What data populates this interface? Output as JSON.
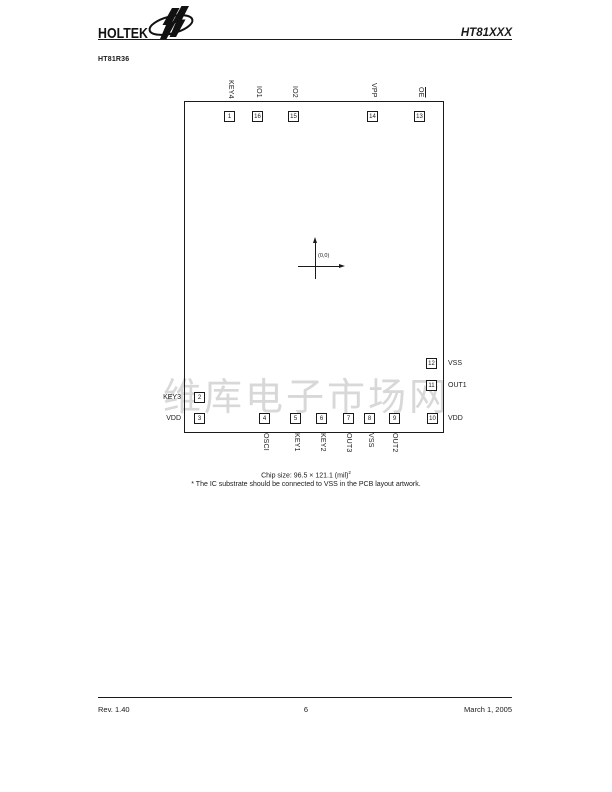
{
  "header": {
    "brand": "HOLTEK",
    "doc_title": "HT81XXX"
  },
  "section_title": "HT81R36",
  "diagram": {
    "origin_label": "(0,0)",
    "top_pads": [
      {
        "num": "1",
        "label": "KEY4"
      },
      {
        "num": "16",
        "label": "IO1"
      },
      {
        "num": "15",
        "label": "IO2"
      },
      {
        "num": "14",
        "label": "VPP"
      },
      {
        "num": "13",
        "label": "OE",
        "overline": true
      }
    ],
    "left_pads": [
      {
        "num": "2",
        "label": "KEY3"
      },
      {
        "num": "3",
        "label": "VDD"
      }
    ],
    "right_pads": [
      {
        "num": "12",
        "label": "VSS"
      },
      {
        "num": "11",
        "label": "OUT1"
      },
      {
        "num": "10",
        "label": "VDD"
      }
    ],
    "bottom_pads": [
      {
        "num": "4",
        "label": "OSCI"
      },
      {
        "num": "5",
        "label": "KEY1"
      },
      {
        "num": "6",
        "label": "KEY2"
      },
      {
        "num": "7",
        "label": "OUT3"
      },
      {
        "num": "8",
        "label": "VSS"
      },
      {
        "num": "9",
        "label": "OUT2"
      }
    ],
    "caption_line1": "Chip size: 96.5 × 121.1 (mil)",
    "caption_sup": "2",
    "caption_line2": "* The IC substrate should be connected to VSS in the PCB layout artwork."
  },
  "watermark": "维库电子市场网",
  "colors": {
    "ink": "#1a1a1a",
    "watermark": "#d8d8d8"
  },
  "footer": {
    "rev": "Rev. 1.40",
    "page": "6",
    "date": "March 1, 2005"
  }
}
